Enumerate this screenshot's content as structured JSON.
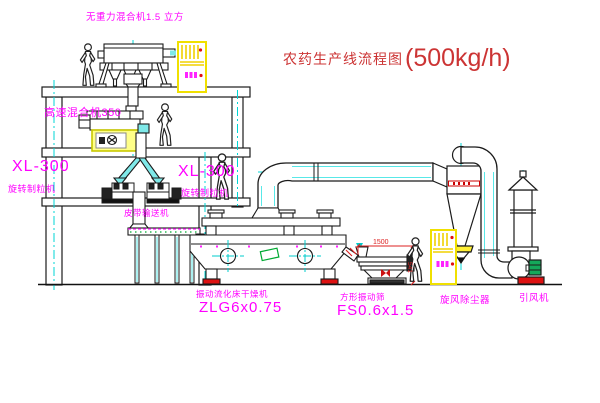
{
  "title": {
    "name": "农药生产线流程图",
    "capacity": "(500kg/h)"
  },
  "equipment": {
    "gravity_mixer": {
      "label": "无重力混合机1.5 立方"
    },
    "high_speed_mixer": {
      "label": "高速混合机350"
    },
    "granulator_left": {
      "model": "XL-300",
      "label": "旋转制粒机"
    },
    "granulator_right": {
      "model": "XL-300",
      "label": "旋转制粒机"
    },
    "belt_conveyor": {
      "label": "皮带输送机"
    },
    "fluid_bed_dryer": {
      "label": "振动流化床干燥机",
      "model": "ZLG6x0.75"
    },
    "vibrating_screen": {
      "label": "方形振动筛",
      "model": "FS0.6x1.5"
    },
    "cyclone_dust_collector": {
      "label": "旋风除尘器"
    },
    "induced_draft_fan": {
      "label": "引风机"
    }
  },
  "dimensions": {
    "screen_length": "1500",
    "screen_height": "541"
  },
  "colors": {
    "label_magenta": "#ff00ff",
    "title_red": "#cc3434",
    "centerline_cyan": "#00d5d5",
    "pipe_fill_cyan": "#7fe9e9",
    "cabinet_yellow": "#f0e000",
    "alert_red": "#e01010",
    "motor_green": "#14a85a"
  }
}
